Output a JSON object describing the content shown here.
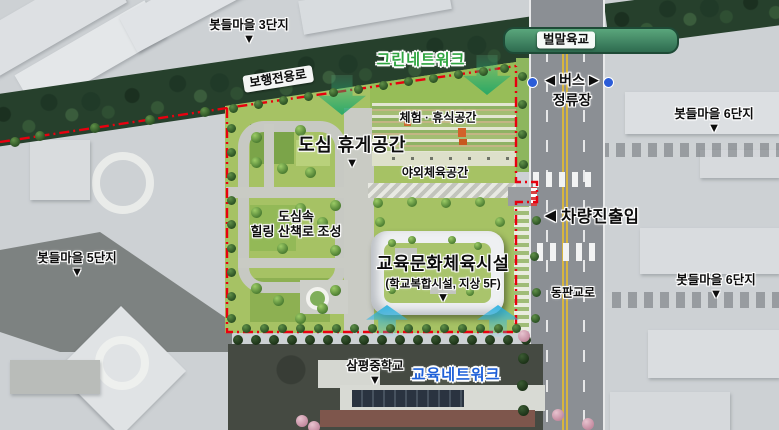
{
  "legend": {
    "pointer": "▼",
    "arrow_left": "◀",
    "arrow_right": "▶"
  },
  "markers": {
    "m3": {
      "label": "봇들마을 3단지"
    },
    "m5": {
      "label": "봇들마을 5단지"
    },
    "m6_top": {
      "label": "봇들마을 6단지"
    },
    "m6_bottom": {
      "label": "봇들마을 6단지"
    },
    "school": {
      "label": "삼평중학교"
    }
  },
  "networks": {
    "green": "그린네트워크",
    "education": "교육네트워크"
  },
  "roads": {
    "pedestrian_only": "보행전용로",
    "bridge": "벌말육교",
    "dongpan": "동판교로"
  },
  "transit": {
    "bus_stop_line1": "버스",
    "bus_stop_line2": "정류장"
  },
  "site": {
    "urban_rest_space": "도심 휴게공간",
    "experience_rest_space": "체험 · 휴식공간",
    "outdoor_sports_space": "야외체육공간",
    "healing_line1": "도심속",
    "healing_line2": "힐링 산책로 조성",
    "facility_name": "교육문화체육시설",
    "facility_subtitle": "(학교복합시설, 지상 5F)",
    "vehicle_access": "차량진출입"
  },
  "colors": {
    "boundary_red": "#e8000f",
    "network_green": "#2fa440",
    "network_blue": "#1d5fd8",
    "bus_dot_blue": "#2b5cd8",
    "site_green": "#a6c264",
    "greenway_dark": "#26402c",
    "arrow_green": "#16a569",
    "arrow_cyan": "#23afe1"
  }
}
